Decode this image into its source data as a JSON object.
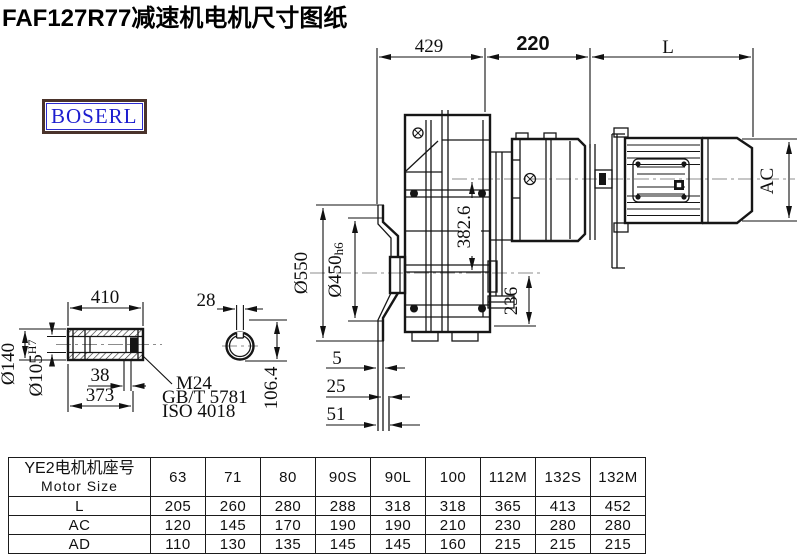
{
  "title": "FAF127R77减速机电机尺寸图纸",
  "brand": "BOSERL",
  "dims": {
    "d429": "429",
    "d220": "220",
    "dL": "L",
    "dAC": "AC",
    "d382": "382.6",
    "d236": "236",
    "d550": "Ø550",
    "d450": "Ø450",
    "d450t": "h6",
    "f5": "5",
    "f25": "25",
    "f51": "51",
    "s410": "410",
    "s28": "28",
    "s140": "Ø140",
    "s105": "Ø105",
    "s105t": "H7",
    "s38": "38",
    "s373": "373",
    "s106": "106.4",
    "m24": "M24",
    "gb": "GB/T 5781",
    "iso": "ISO 4018"
  },
  "table": {
    "header_cn": "YE2电机机座号",
    "header_en": "Motor Size",
    "columns": [
      "63",
      "71",
      "80",
      "90S",
      "90L",
      "100",
      "112M",
      "132S",
      "132M"
    ],
    "rows": [
      {
        "label": "L",
        "values": [
          "205",
          "260",
          "280",
          "288",
          "318",
          "318",
          "365",
          "413",
          "452"
        ]
      },
      {
        "label": "AC",
        "values": [
          "120",
          "145",
          "170",
          "190",
          "190",
          "210",
          "230",
          "280",
          "280"
        ]
      },
      {
        "label": "AD",
        "values": [
          "110",
          "130",
          "135",
          "145",
          "145",
          "160",
          "215",
          "215",
          "215"
        ]
      }
    ]
  }
}
